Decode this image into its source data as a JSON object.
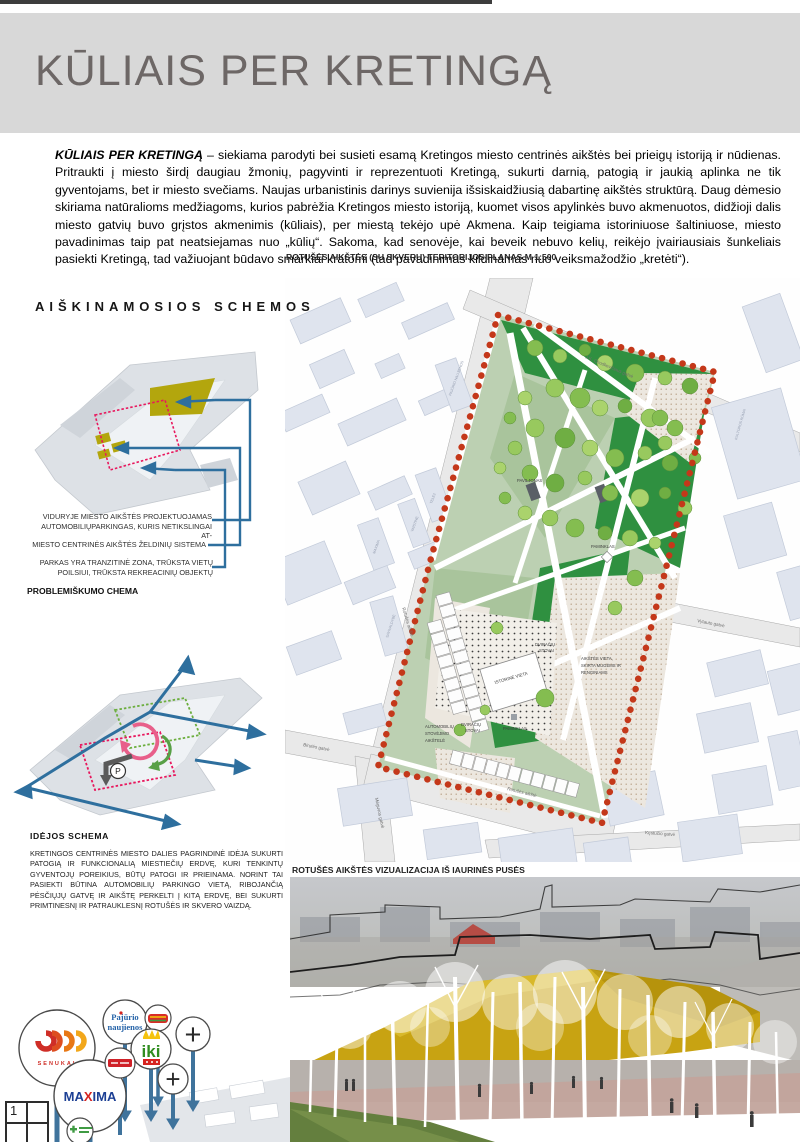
{
  "page": {
    "sheet_number": "1"
  },
  "header": {
    "title": "KŪLIAIS PER KRETINGĄ"
  },
  "intro": {
    "lead": "KŪLIAIS PER KRETINGĄ",
    "body": " – siekiama parodyti bei susieti esamą Kretingos miesto centrinės aikštės bei prieigų istoriją ir nūdienas. Pritraukti į miesto širdį daugiau žmonių, pagyvinti ir reprezentuoti Kretingą, sukurti darnią, patogią ir jaukią aplinka ne tik gyventojams, bet ir miesto svečiams. Naujas urbanistinis darinys suvienija išsiskaidžiusią dabartinę aikštės struktūrą. Daug dėmesio skiriama natūralioms medžiagoms, kurios pabrėžia Kretingos miesto istoriją, kuomet visos apylinkės buvo akmenuotos, didžioji dalis miesto gatvių buvo grįstos akmenimis (kūliais), per miestą tekėjo upė Akmena. Kaip teigiama istoriniuose šaltiniuose, miesto pavadinimas taip pat neatsiejamas nuo „kūlių“. Sakoma, kad senovėje, kai beveik nebuvo kelių, reikėjo įvairiausiais šunkeliais pasiekti Kretingą, tad važiuojant būdavo smarkiai kratomi (tad pavadinimas kildinamas nuo veiksmažodžio „kretėti“)."
  },
  "schemes": {
    "heading": "AIŠKINAMOSIOS SCHEMOS",
    "problem_title": "PROBLEMIŠKUMO CHEMA",
    "problem_labels": [
      "VIDURYJE MIESTO AIKŠTĖS PROJEKTUOJAMAS AUTOMOBILIŲPARKINGAS, KURIS NETIKSLINGAI AT-",
      "MIESTO CENTRINĖS AIKŠTĖS ŽELDINIŲ SISTEMA",
      "PARKAS YRA TRANZITINĖ ZONA, TRŪKSTA VIETŲ POILSIUI, TRŪKSTA REKREACINIŲ OBJEKTŲ"
    ],
    "idea_title": "IDĖJOS SCHEMA",
    "idea_body": "KRETINGOS CENTRINĖS MIESTO DALIES PAGRINDINĖ IDĖJA SUKURTI PATOGIĄ IR FUNKCIONALIĄ MIESTIEČIŲ ERDVĘ, KURI TENKINTŲ GYVENTOJŲ POREIKIUS, BŪTŲ PATOGI IR PRIEINAMA. NORINT TAI PASIEKTI BŪTINA AUTOMOBILIŲ PARKINGO VIETĄ, RIBOJANČIĄ PĖSČIŲJŲ GATVĘ IR AIKŠTĘ PERKELTI Į KITĄ ERDVĘ, BEI SUKURTI PRIMTINESNĮ IR PATRAUKLESNĮ ROTUŠĖS IR SKVERO VAIZDĄ.",
    "parking_symbol": "P"
  },
  "plan": {
    "caption": "ROTUŠĖS AIKŠTĖS (SU SKVERU) TERITORIJOS PLANAS M 1:500",
    "streets": {
      "chodkeviciaus": "J.K. Chodkevičiaus gatvė",
      "vytauto": "Vytauto gatvė",
      "birutes": "Birutės gatvė",
      "meguvos": "Mėguvos gatvė",
      "kestucio": "Kęstučio gatvė",
      "rotuses_left": "Rotušės aikštė",
      "rotuses_bottom": "Rotušės aikštė"
    },
    "buildings": {
      "pajurio": "PAJŪRIO NAUJIENOS",
      "tele2": "TELE2",
      "vaistine": "VAISTINĖ",
      "maxima": "MAXIMA",
      "savivaldybe": "SAVIVALDYBĖ",
      "kulturos": "KULTŪROS RŪMAI"
    },
    "labels": {
      "paviljonas": "PAVILJONAS",
      "paminklas_top": "PAMINKLAS",
      "paminklas_green": "PAMINKLAS",
      "istorine": "ISTORINĖ VIETA",
      "dviraciu_a1": "DVIRAČIŲ",
      "dviraciu_a2": "STOVAI",
      "dviraciu_b1": "DVIRAČIŲ",
      "dviraciu_b2": "STOVAI",
      "event_1": "AIKŠTĖS VIETA,",
      "event_2": "SKIRTA MUGĖMS IR",
      "event_3": "RENGINIAMS",
      "parking_1": "AUTOMOBILIŲ",
      "parking_2": "STOVĖJIMO",
      "parking_3": "AIKŠTELĖ"
    },
    "colors": {
      "boundary_dots": "#c4381a",
      "park_green": "#2f9040",
      "sage": "#bcd0b2"
    }
  },
  "visualization": {
    "caption": "ROTUŠĖS AIKŠTĖS VIZUALIZACIJA IŠ IAURINĖS PUSĖS"
  },
  "signage": {
    "senukai": "SENUKAI",
    "maxima_a": "MA",
    "maxima_x": "X",
    "maxima_b": "IMA",
    "pajurio_1": "Pajūrio",
    "pajurio_2": "naujienos",
    "iki": "iki",
    "plus_1": "+",
    "plus_2": "+",
    "colors": {
      "stem_blue": "#3f739c",
      "maxima_blue": "#1c3f94",
      "maxima_red": "#d6231f",
      "iki_green": "#2f8d1f"
    }
  }
}
